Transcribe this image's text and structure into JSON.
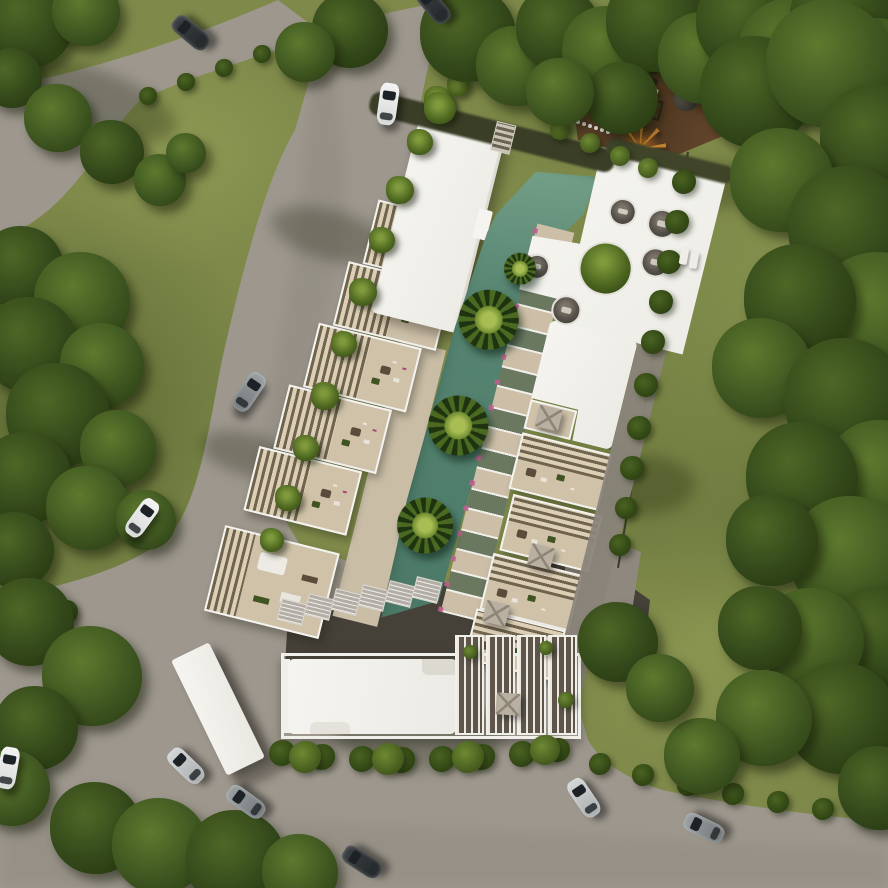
{
  "scene": {
    "type": "aerial architectural render",
    "subject": "residential apartment complex with lagoon pool, roof deck, playground, surrounding roads and forest",
    "palette": {
      "grass": "#7e894a",
      "forest": "#3c511f",
      "forest_dark": "#22330e",
      "road": "#9d978d",
      "road_shade": "#7f7a71",
      "pool": "#578572",
      "pool_light": "#79a48c",
      "roof_white": "#f4f3ef",
      "terrace": "#cfc2a9",
      "pergola_light": "#dccfb6",
      "pergola_dark": "#6f644e",
      "mulch_brown": "#6b4c31",
      "lower_level_dark": "#454139",
      "hedge_green": "#2f4413",
      "bougainvillea_pink": "#b1487c",
      "parasol_gray": "#b9b0a2",
      "fence_dark": "#3f3a30",
      "car_dark": "#2e3134",
      "car_silver": "#b9bcbe",
      "car_white": "#e9ebea"
    },
    "counts": {
      "cars": 11,
      "pool_palms": 4,
      "sunken_lounges": 5,
      "storage_boxes": 6,
      "louver_panels": 4
    }
  },
  "sprites": [
    {
      "k": "shadowE",
      "p": "g",
      "x": 95,
      "y": 100,
      "w": 170,
      "h": 60,
      "rot": 20
    },
    {
      "k": "shadowE",
      "p": "g",
      "x": 330,
      "y": 235,
      "w": 120,
      "h": 50,
      "rot": 15
    },
    {
      "k": "shadowE",
      "p": "g",
      "x": 420,
      "y": 735,
      "w": 170,
      "h": 70,
      "rot": 0
    },
    {
      "k": "shadowE",
      "p": "g",
      "x": 250,
      "y": 455,
      "w": 100,
      "h": 42,
      "rot": 15
    },
    {
      "k": "shadowE",
      "p": "g",
      "x": 700,
      "y": 185,
      "w": 130,
      "h": 50,
      "rot": 0
    },
    {
      "k": "shadowE",
      "p": "g",
      "x": 640,
      "y": 485,
      "w": 110,
      "h": 60,
      "rot": 0
    },
    {
      "k": "bush",
      "p": "s",
      "x": 148,
      "y": 96,
      "r": 9
    },
    {
      "k": "bush",
      "p": "s",
      "x": 186,
      "y": 82,
      "r": 9
    },
    {
      "k": "bush",
      "p": "s",
      "x": 224,
      "y": 68,
      "r": 9
    },
    {
      "k": "bush",
      "p": "s",
      "x": 262,
      "y": 54,
      "r": 9
    },
    {
      "k": "bush",
      "p": "s",
      "x": 298,
      "y": 42,
      "r": 9
    },
    {
      "k": "bush",
      "p": "s",
      "x": 66,
      "y": 612,
      "r": 12
    },
    {
      "k": "bush",
      "p": "s",
      "x": 84,
      "y": 652,
      "r": 11
    },
    {
      "k": "bush",
      "p": "s",
      "x": 100,
      "y": 694,
      "r": 12
    },
    {
      "k": "bush",
      "p": "s",
      "x": 282,
      "y": 753,
      "r": 13
    },
    {
      "k": "bush",
      "p": "s",
      "x": 322,
      "y": 757,
      "r": 13
    },
    {
      "k": "bush",
      "p": "s",
      "x": 362,
      "y": 759,
      "r": 13
    },
    {
      "k": "bush",
      "p": "s",
      "x": 402,
      "y": 760,
      "r": 13
    },
    {
      "k": "bush",
      "p": "s",
      "x": 442,
      "y": 759,
      "r": 13
    },
    {
      "k": "bush",
      "p": "s",
      "x": 482,
      "y": 757,
      "r": 13
    },
    {
      "k": "bush",
      "p": "s",
      "x": 522,
      "y": 754,
      "r": 13
    },
    {
      "k": "bush",
      "p": "s",
      "x": 558,
      "y": 750,
      "r": 12
    },
    {
      "k": "bushL",
      "p": "s",
      "x": 305,
      "y": 757,
      "r": 16
    },
    {
      "k": "bushL",
      "p": "s",
      "x": 388,
      "y": 759,
      "r": 16
    },
    {
      "k": "bushL",
      "p": "s",
      "x": 468,
      "y": 757,
      "r": 16
    },
    {
      "k": "bushL",
      "p": "s",
      "x": 545,
      "y": 750,
      "r": 15
    },
    {
      "k": "bush",
      "p": "s",
      "x": 600,
      "y": 764,
      "r": 11
    },
    {
      "k": "bush",
      "p": "s",
      "x": 643,
      "y": 775,
      "r": 11
    },
    {
      "k": "bush",
      "p": "s",
      "x": 688,
      "y": 785,
      "r": 11
    },
    {
      "k": "bush",
      "p": "s",
      "x": 733,
      "y": 794,
      "r": 11
    },
    {
      "k": "bush",
      "p": "s",
      "x": 778,
      "y": 802,
      "r": 11
    },
    {
      "k": "bush",
      "p": "s",
      "x": 823,
      "y": 809,
      "r": 11
    },
    {
      "k": "bush",
      "p": "s",
      "x": 866,
      "y": 815,
      "r": 11
    },
    {
      "k": "bush",
      "p": "s",
      "x": 684,
      "y": 182,
      "r": 12
    },
    {
      "k": "bush",
      "p": "s",
      "x": 677,
      "y": 222,
      "r": 12
    },
    {
      "k": "bush",
      "p": "s",
      "x": 669,
      "y": 262,
      "r": 12
    },
    {
      "k": "bush",
      "p": "s",
      "x": 661,
      "y": 302,
      "r": 12
    },
    {
      "k": "bush",
      "p": "s",
      "x": 653,
      "y": 342,
      "r": 12
    },
    {
      "k": "bush",
      "p": "s",
      "x": 646,
      "y": 385,
      "r": 12
    },
    {
      "k": "bush",
      "p": "s",
      "x": 639,
      "y": 428,
      "r": 12
    },
    {
      "k": "bush",
      "p": "s",
      "x": 632,
      "y": 468,
      "r": 12
    },
    {
      "k": "bush",
      "p": "s",
      "x": 626,
      "y": 508,
      "r": 11
    },
    {
      "k": "bush",
      "p": "s",
      "x": 620,
      "y": 545,
      "r": 11
    },
    {
      "k": "bushL",
      "p": "s",
      "x": 560,
      "y": 130,
      "r": 10
    },
    {
      "k": "bushL",
      "p": "s",
      "x": 590,
      "y": 143,
      "r": 10
    },
    {
      "k": "bushL",
      "p": "s",
      "x": 620,
      "y": 156,
      "r": 10
    },
    {
      "k": "bushL",
      "p": "s",
      "x": 648,
      "y": 168,
      "r": 10
    },
    {
      "k": "bushL",
      "p": "s",
      "x": 470,
      "y": 652,
      "r": 7
    },
    {
      "k": "bushL",
      "p": "s",
      "x": 546,
      "y": 648,
      "r": 7
    },
    {
      "k": "bushL",
      "p": "s",
      "x": 566,
      "y": 700,
      "r": 8
    },
    {
      "k": "palm",
      "p": "s",
      "x": 438,
      "y": 100,
      "r": 14
    },
    {
      "k": "palm",
      "p": "s",
      "x": 420,
      "y": 142,
      "r": 13
    },
    {
      "k": "palm",
      "p": "s",
      "x": 400,
      "y": 190,
      "r": 14
    },
    {
      "k": "palm",
      "p": "s",
      "x": 382,
      "y": 240,
      "r": 13
    },
    {
      "k": "palm",
      "p": "s",
      "x": 363,
      "y": 292,
      "r": 14
    },
    {
      "k": "palm",
      "p": "s",
      "x": 344,
      "y": 344,
      "r": 13
    },
    {
      "k": "palm",
      "p": "s",
      "x": 325,
      "y": 396,
      "r": 14
    },
    {
      "k": "palm",
      "p": "s",
      "x": 306,
      "y": 448,
      "r": 13
    },
    {
      "k": "palm",
      "p": "s",
      "x": 288,
      "y": 498,
      "r": 13
    },
    {
      "k": "palm",
      "p": "s",
      "x": 272,
      "y": 540,
      "r": 12
    },
    {
      "k": "palm",
      "p": "s",
      "x": 440,
      "y": 108,
      "r": 16
    },
    {
      "k": "palm",
      "p": "s",
      "x": 458,
      "y": 85,
      "r": 11
    },
    {
      "k": "flower",
      "p": "s",
      "x": 410,
      "y": 160
    },
    {
      "k": "flower",
      "p": "s",
      "x": 370,
      "y": 270
    },
    {
      "k": "flower",
      "p": "s",
      "x": 330,
      "y": 380
    },
    {
      "k": "flower",
      "p": "s",
      "x": 295,
      "y": 470
    },
    {
      "k": "flower",
      "p": "s",
      "x": 292,
      "y": 740
    },
    {
      "k": "flower",
      "p": "s",
      "x": 335,
      "y": 741
    },
    {
      "k": "flower",
      "p": "s",
      "x": 377,
      "y": 742
    },
    {
      "k": "flower",
      "p": "s",
      "x": 420,
      "y": 742
    },
    {
      "k": "flower",
      "p": "s",
      "x": 462,
      "y": 741
    },
    {
      "k": "flower",
      "p": "s",
      "x": 505,
      "y": 739
    },
    {
      "k": "flower",
      "p": "s",
      "x": 540,
      "y": 737
    },
    {
      "k": "flower",
      "p": "s",
      "x": 203,
      "y": 627
    },
    {
      "k": "flowerP",
      "p": "s",
      "x": 292,
      "y": 764
    },
    {
      "k": "flowerP",
      "p": "s",
      "x": 130,
      "y": 764
    },
    {
      "k": "box",
      "p": "s",
      "x": 292,
      "y": 612,
      "rot": 14
    },
    {
      "k": "box",
      "p": "s",
      "x": 319,
      "y": 607,
      "rot": 14
    },
    {
      "k": "box",
      "p": "s",
      "x": 346,
      "y": 602,
      "rot": 14
    },
    {
      "k": "box",
      "p": "s",
      "x": 373,
      "y": 598,
      "rot": 14
    },
    {
      "k": "box",
      "p": "s",
      "x": 400,
      "y": 594,
      "rot": 14
    },
    {
      "k": "box",
      "p": "s",
      "x": 427,
      "y": 590,
      "rot": 14
    },
    {
      "k": "wrect",
      "p": "s",
      "x": 650,
      "y": 92,
      "w": 16,
      "h": 9,
      "rot": 14
    },
    {
      "k": "wrect",
      "p": "s",
      "x": 684,
      "y": 256,
      "w": 8,
      "h": 17,
      "rot": 10
    },
    {
      "k": "wrect",
      "p": "s",
      "x": 694,
      "y": 260,
      "w": 8,
      "h": 17,
      "rot": 10
    },
    {
      "k": "parasol",
      "p": "s",
      "x": 508,
      "y": 704,
      "rot": 4
    },
    {
      "k": "cseat",
      "p": "c",
      "x": 332,
      "y": 48,
      "r": 14
    },
    {
      "k": "cseat",
      "p": "c",
      "x": 373,
      "y": 50,
      "r": 15
    },
    {
      "k": "cseat",
      "p": "c",
      "x": 376,
      "y": 89,
      "r": 15
    },
    {
      "k": "cseat",
      "p": "c",
      "x": 301,
      "y": 157,
      "r": 15
    },
    {
      "k": "cseat",
      "p": "c",
      "x": 262,
      "y": 122,
      "r": 13
    },
    {
      "k": "ctree",
      "p": "c",
      "x": 329,
      "y": 107,
      "r": 27
    },
    {
      "k": "ppalm",
      "p": "c",
      "x": 228,
      "y": 185,
      "r": 30
    },
    {
      "k": "ppalm",
      "p": "c",
      "x": 224,
      "y": 295,
      "r": 30
    },
    {
      "k": "ppalm",
      "p": "c",
      "x": 216,
      "y": 400,
      "r": 28
    },
    {
      "k": "ppalm",
      "p": "c",
      "x": 246,
      "y": 128,
      "r": 16
    },
    {
      "k": "parasol",
      "p": "c",
      "x": 310,
      "y": 266,
      "rot": 0
    },
    {
      "k": "parasol",
      "p": "c",
      "x": 336,
      "y": 402,
      "rot": 0
    },
    {
      "k": "parasol",
      "p": "c",
      "x": 306,
      "y": 468,
      "rot": 0
    },
    {
      "k": "tree",
      "p": "s",
      "x": 28,
      "y": 22,
      "r": 46,
      "v": 0
    },
    {
      "k": "tree",
      "p": "s",
      "x": 86,
      "y": 12,
      "r": 34,
      "v": 1
    },
    {
      "k": "tree",
      "p": "s",
      "x": 12,
      "y": 78,
      "r": 30,
      "v": 0
    },
    {
      "k": "tree",
      "p": "s",
      "x": 58,
      "y": 118,
      "r": 34,
      "v": 1
    },
    {
      "k": "tree",
      "p": "s",
      "x": 112,
      "y": 152,
      "r": 32,
      "v": 0
    },
    {
      "k": "tree",
      "p": "s",
      "x": 160,
      "y": 180,
      "r": 26,
      "v": 1
    },
    {
      "k": "tree",
      "p": "s",
      "x": 186,
      "y": 153,
      "r": 20,
      "v": 1
    },
    {
      "k": "tree",
      "p": "s",
      "x": 22,
      "y": 268,
      "r": 42,
      "v": 0
    },
    {
      "k": "tree",
      "p": "s",
      "x": 82,
      "y": 300,
      "r": 48,
      "v": 1
    },
    {
      "k": "tree",
      "p": "s",
      "x": 30,
      "y": 345,
      "r": 48,
      "v": 0
    },
    {
      "k": "tree",
      "p": "s",
      "x": 102,
      "y": 365,
      "r": 42,
      "v": 1
    },
    {
      "k": "tree",
      "p": "s",
      "x": 58,
      "y": 415,
      "r": 52,
      "v": 0
    },
    {
      "k": "tree",
      "p": "s",
      "x": 118,
      "y": 448,
      "r": 38,
      "v": 1
    },
    {
      "k": "tree",
      "p": "s",
      "x": 26,
      "y": 478,
      "r": 46,
      "v": 0
    },
    {
      "k": "tree",
      "p": "s",
      "x": 88,
      "y": 508,
      "r": 42,
      "v": 1
    },
    {
      "k": "tree",
      "p": "s",
      "x": 16,
      "y": 550,
      "r": 38,
      "v": 0
    },
    {
      "k": "tree",
      "p": "s",
      "x": 146,
      "y": 520,
      "r": 30,
      "v": 1
    },
    {
      "k": "tree",
      "p": "s",
      "x": 30,
      "y": 622,
      "r": 44,
      "v": 0
    },
    {
      "k": "tree",
      "p": "s",
      "x": 92,
      "y": 676,
      "r": 50,
      "v": 1
    },
    {
      "k": "tree",
      "p": "s",
      "x": 36,
      "y": 728,
      "r": 42,
      "v": 0
    },
    {
      "k": "tree",
      "p": "s",
      "x": 12,
      "y": 788,
      "r": 38,
      "v": 1
    },
    {
      "k": "tree",
      "p": "s",
      "x": 96,
      "y": 828,
      "r": 46,
      "v": 0
    },
    {
      "k": "tree",
      "p": "s",
      "x": 160,
      "y": 846,
      "r": 48,
      "v": 1
    },
    {
      "k": "tree",
      "p": "s",
      "x": 236,
      "y": 860,
      "r": 50,
      "v": 0
    },
    {
      "k": "tree",
      "p": "s",
      "x": 300,
      "y": 872,
      "r": 38,
      "v": 1
    },
    {
      "k": "tree",
      "p": "s",
      "x": 468,
      "y": 34,
      "r": 48,
      "v": 0
    },
    {
      "k": "tree",
      "p": "s",
      "x": 516,
      "y": 66,
      "r": 40,
      "v": 1
    },
    {
      "k": "tree",
      "p": "s",
      "x": 558,
      "y": 28,
      "r": 42,
      "v": 0
    },
    {
      "k": "tree",
      "p": "s",
      "x": 608,
      "y": 52,
      "r": 46,
      "v": 1
    },
    {
      "k": "tree",
      "p": "s",
      "x": 656,
      "y": 22,
      "r": 50,
      "v": 0
    },
    {
      "k": "tree",
      "p": "s",
      "x": 704,
      "y": 58,
      "r": 46,
      "v": 1
    },
    {
      "k": "tree",
      "p": "s",
      "x": 748,
      "y": 22,
      "r": 52,
      "v": 0
    },
    {
      "k": "tree",
      "p": "s",
      "x": 794,
      "y": 54,
      "r": 56,
      "v": 1
    },
    {
      "k": "tree",
      "p": "s",
      "x": 842,
      "y": 18,
      "r": 52,
      "v": 0
    },
    {
      "k": "tree",
      "p": "s",
      "x": 878,
      "y": 66,
      "r": 48,
      "v": 1
    },
    {
      "k": "tree",
      "p": "s",
      "x": 622,
      "y": 98,
      "r": 36,
      "v": 0
    },
    {
      "k": "tree",
      "p": "s",
      "x": 560,
      "y": 92,
      "r": 34,
      "v": 1
    },
    {
      "k": "tree",
      "p": "s",
      "x": 350,
      "y": 30,
      "r": 38,
      "v": 0
    },
    {
      "k": "tree",
      "p": "s",
      "x": 305,
      "y": 52,
      "r": 30,
      "v": 1
    },
    {
      "k": "tree",
      "p": "s",
      "x": 756,
      "y": 92,
      "r": 56,
      "v": 0
    },
    {
      "k": "tree",
      "p": "s",
      "x": 830,
      "y": 64,
      "r": 64,
      "v": 1
    },
    {
      "k": "tree",
      "p": "s",
      "x": 876,
      "y": 140,
      "r": 56,
      "v": 0
    },
    {
      "k": "tree",
      "p": "s",
      "x": 782,
      "y": 180,
      "r": 52,
      "v": 1
    },
    {
      "k": "tree",
      "p": "s",
      "x": 850,
      "y": 228,
      "r": 62,
      "v": 0
    },
    {
      "k": "tree",
      "p": "s",
      "x": 880,
      "y": 318,
      "r": 66,
      "v": 1
    },
    {
      "k": "tree",
      "p": "s",
      "x": 800,
      "y": 300,
      "r": 56,
      "v": 0
    },
    {
      "k": "tree",
      "p": "s",
      "x": 762,
      "y": 368,
      "r": 50,
      "v": 1
    },
    {
      "k": "tree",
      "p": "s",
      "x": 846,
      "y": 400,
      "r": 62,
      "v": 0
    },
    {
      "k": "tree",
      "p": "s",
      "x": 882,
      "y": 478,
      "r": 58,
      "v": 1
    },
    {
      "k": "tree",
      "p": "s",
      "x": 802,
      "y": 478,
      "r": 56,
      "v": 0
    },
    {
      "k": "tree",
      "p": "s",
      "x": 852,
      "y": 558,
      "r": 62,
      "v": 1
    },
    {
      "k": "tree",
      "p": "s",
      "x": 772,
      "y": 540,
      "r": 46,
      "v": 0
    },
    {
      "k": "tree",
      "p": "s",
      "x": 880,
      "y": 638,
      "r": 52,
      "v": 0
    },
    {
      "k": "tree",
      "p": "s",
      "x": 812,
      "y": 640,
      "r": 52,
      "v": 1
    },
    {
      "k": "tree",
      "p": "s",
      "x": 760,
      "y": 628,
      "r": 42,
      "v": 0
    },
    {
      "k": "tree",
      "p": "s",
      "x": 842,
      "y": 718,
      "r": 56,
      "v": 0
    },
    {
      "k": "tree",
      "p": "s",
      "x": 764,
      "y": 718,
      "r": 48,
      "v": 1
    },
    {
      "k": "tree",
      "p": "s",
      "x": 880,
      "y": 788,
      "r": 42,
      "v": 0
    },
    {
      "k": "tree",
      "p": "s",
      "x": 702,
      "y": 756,
      "r": 38,
      "v": 1
    },
    {
      "k": "tree",
      "p": "s",
      "x": 618,
      "y": 642,
      "r": 40,
      "v": 0
    },
    {
      "k": "tree",
      "p": "s",
      "x": 660,
      "y": 688,
      "r": 34,
      "v": 1
    },
    {
      "k": "car",
      "p": "s",
      "x": 191,
      "y": 33,
      "rot": -50,
      "v": "dark"
    },
    {
      "k": "car",
      "p": "s",
      "x": 433,
      "y": 5,
      "rot": -40,
      "v": "dark"
    },
    {
      "k": "car",
      "p": "s",
      "x": 388,
      "y": 104,
      "rot": 8,
      "v": "white"
    },
    {
      "k": "car",
      "p": "s",
      "x": 249,
      "y": 392,
      "rot": 34,
      "v": "gray"
    },
    {
      "k": "car",
      "p": "s",
      "x": 142,
      "y": 518,
      "rot": 36,
      "v": "white"
    },
    {
      "k": "car",
      "p": "s",
      "x": 186,
      "y": 766,
      "rot": -46,
      "v": "silver"
    },
    {
      "k": "car",
      "p": "s",
      "x": 246,
      "y": 802,
      "rot": -54,
      "v": "gray"
    },
    {
      "k": "car",
      "p": "s",
      "x": 8,
      "y": 768,
      "rot": 10,
      "v": "white"
    },
    {
      "k": "car",
      "p": "s",
      "x": 584,
      "y": 798,
      "rot": -34,
      "v": "silver"
    },
    {
      "k": "car",
      "p": "s",
      "x": 362,
      "y": 862,
      "rot": -57,
      "v": "dark"
    },
    {
      "k": "car",
      "p": "s",
      "x": 704,
      "y": 828,
      "rot": -64,
      "v": "gray"
    }
  ]
}
